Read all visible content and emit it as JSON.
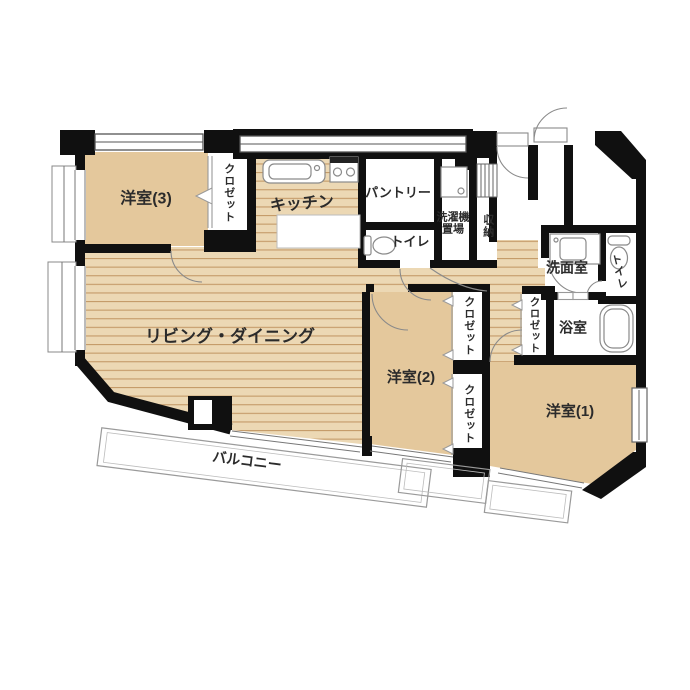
{
  "plan_type": "apartment-floorplan",
  "palette": {
    "wall": "#101010",
    "room_tan": "#e4c89c",
    "floor_base": "#ecd8b4",
    "floor_line": "#c49a68",
    "white_room": "#ffffff",
    "thin_line": "#8a8a8a",
    "balcony_line": "#9a9a9a",
    "text": "#2b2b2b"
  },
  "rooms": {
    "bedroom3": {
      "label": "洋室(3)"
    },
    "closet_bed3": {
      "label": "クロゼット"
    },
    "kitchen": {
      "label": "キッチン"
    },
    "pantry": {
      "label": "パントリー"
    },
    "toilet_hall": {
      "label": "トイレ"
    },
    "laundry": {
      "label_line1": "洗濯機",
      "label_line2": "置場"
    },
    "storage": {
      "label": "収納"
    },
    "washroom": {
      "label": "洗面室"
    },
    "toilet_side": {
      "label": "トイレ"
    },
    "bathroom": {
      "label": "浴室"
    },
    "closet_bed1": {
      "label": "クロゼット"
    },
    "living": {
      "label": "リビング・ダイニング"
    },
    "bedroom2": {
      "label": "洋室(2)"
    },
    "closet_bed2_top": {
      "label": "クロゼット"
    },
    "closet_bed2_bottom": {
      "label": "クロゼット"
    },
    "bedroom1": {
      "label": "洋室(1)"
    },
    "balcony": {
      "label": "バルコニー"
    }
  },
  "icons": {
    "sink": "kitchen-sink-icon",
    "stove": "gas-stove-icon",
    "toilet": "toilet-icon",
    "washer": "washing-machine-icon",
    "tub": "bathtub-icon",
    "vanity": "vanity-sink-icon",
    "shelf": "storage-shelf-icon"
  }
}
